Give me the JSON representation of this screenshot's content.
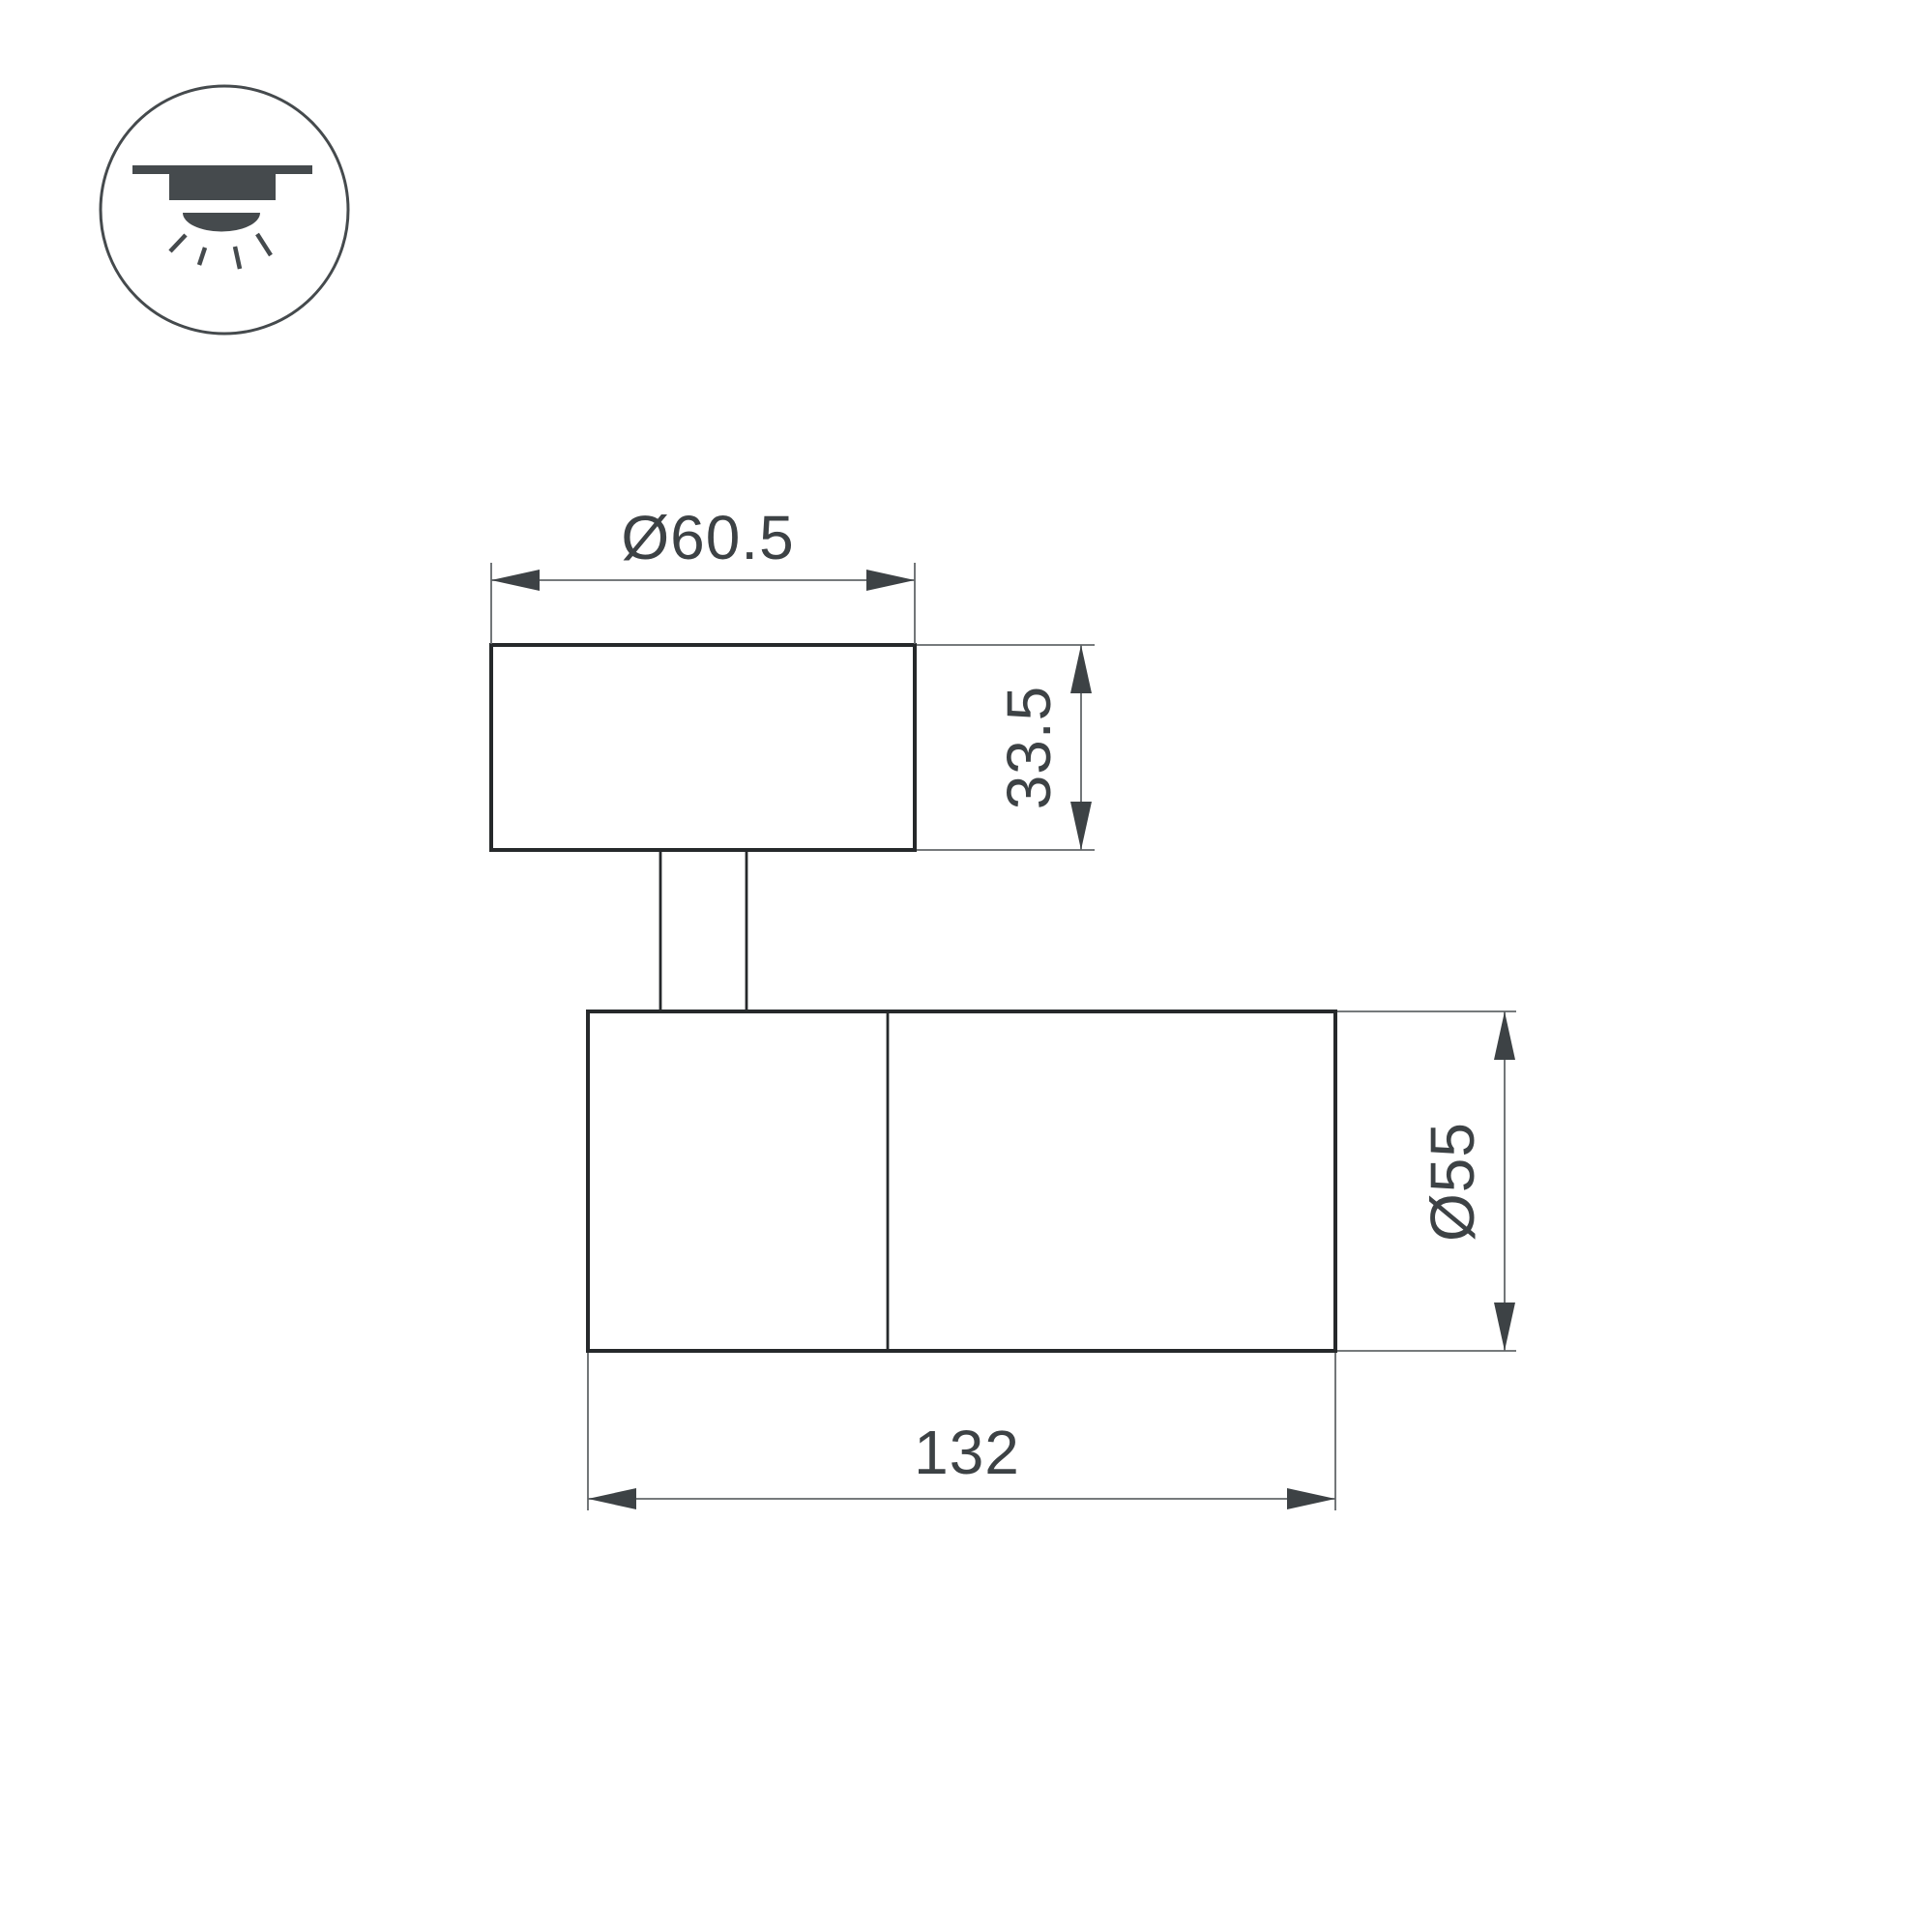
{
  "page": {
    "type": "technical-dimension-drawing",
    "background": "#ffffff"
  },
  "icon": {
    "name": "surface-ceiling-mount-icon"
  },
  "dimensions": {
    "canopy_diameter": "Ø60.5",
    "canopy_height": "33.5",
    "body_diameter": "Ø55",
    "body_length": "132"
  },
  "colors": {
    "outline": "#26292b",
    "dimension_lines": "#63676a",
    "text": "#3d4245",
    "icon": "#454a4d"
  }
}
